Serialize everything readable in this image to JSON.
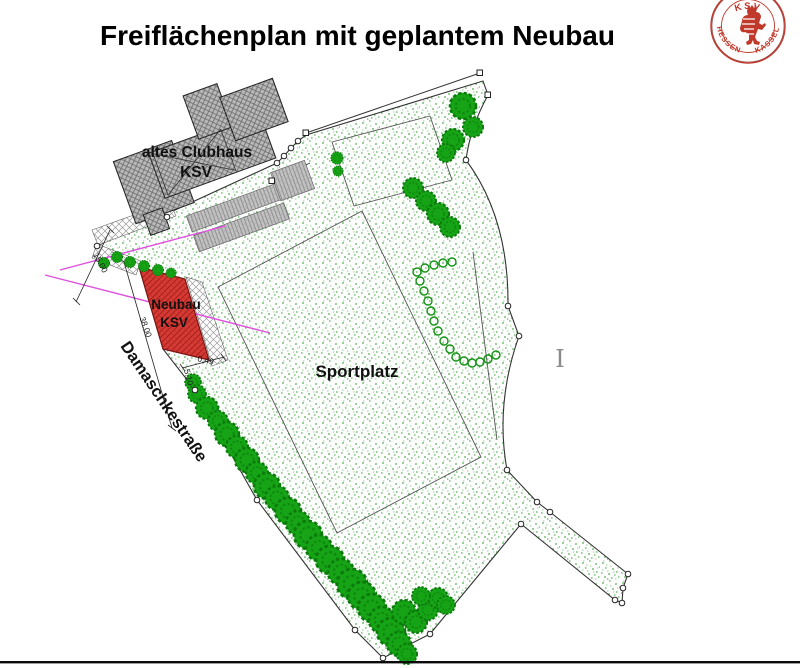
{
  "title": "Freiflächenplan mit geplantem Neubau",
  "logo": {
    "name": "ksv-hessen-kassel-badge",
    "top": "KSV",
    "bottom_left": "HESSEN",
    "bottom_right": "KASSEL"
  },
  "plan": {
    "old_clubhouse": {
      "line1": "altes Clubhaus",
      "line2": "KSV"
    },
    "new_building": {
      "line1": "Neubau",
      "line2": "KSV"
    },
    "sports_field": "Sportplatz",
    "street": "Damaschkestraße",
    "cursor_artifact": "I",
    "dimensions": {
      "d15": "15.00",
      "d38": "38.00",
      "d510": "5.10",
      "d049": "0.49"
    }
  },
  "colors": {
    "new_building_red": "#d63b36",
    "tree_green": "#16a316",
    "stipple_green": "#5fb35f",
    "building_gray": "#b9b9b9",
    "hatch_dark": "#6e6e6e",
    "construction_magenta": "#e050e0",
    "logo_red": "#c0392b",
    "boundary_line": "#333333"
  }
}
